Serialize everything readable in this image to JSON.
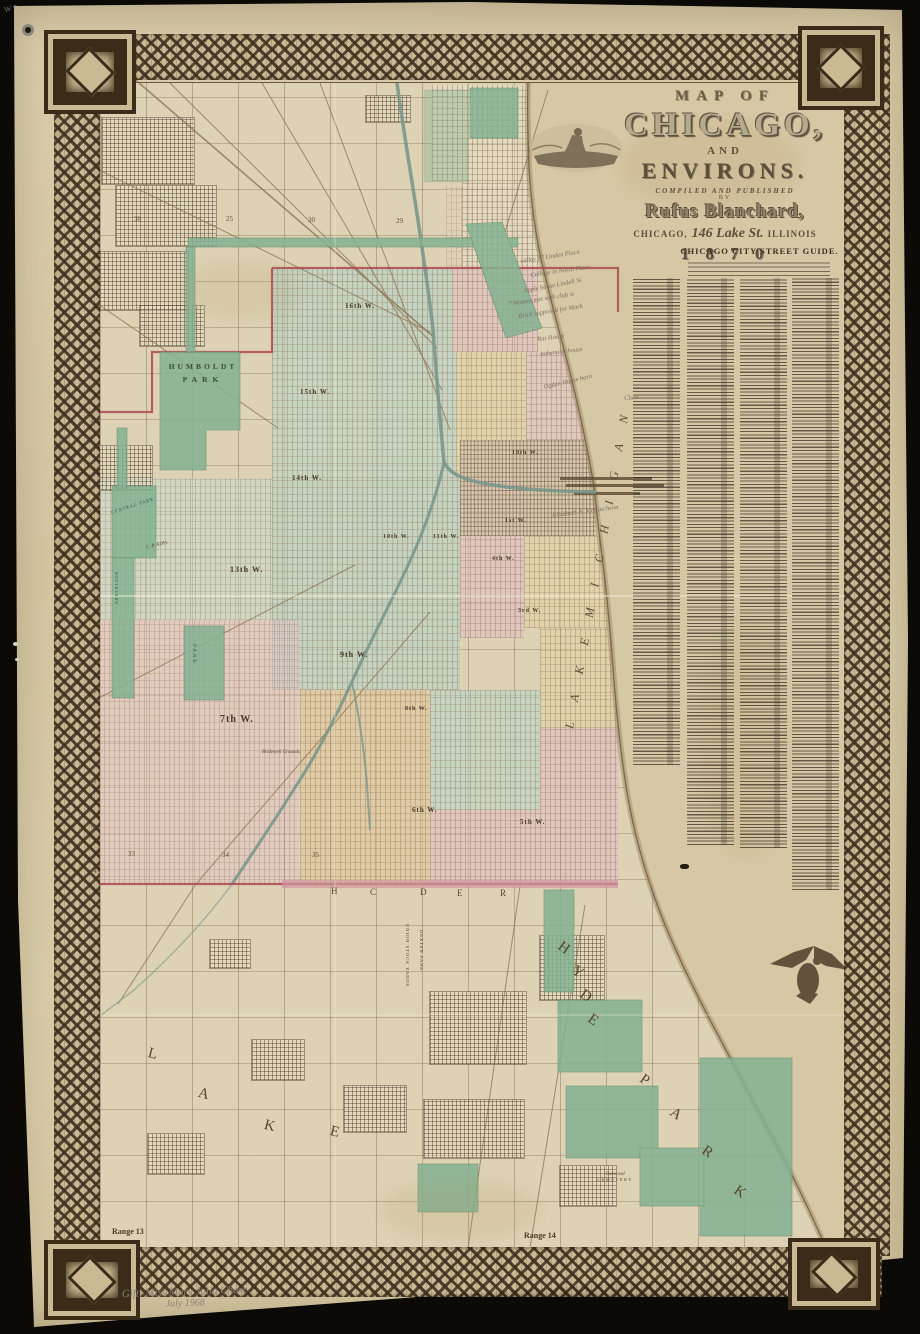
{
  "title_block": {
    "map_of": "MAP OF",
    "chicago": "CHICAGO,",
    "and": "AND",
    "environs": "ENVIRONS.",
    "compiled": "COMPILED AND PUBLISHED",
    "by": "BY",
    "publisher": "Rufus Blanchard,",
    "address_city": "CHICAGO,",
    "address_street": "146 Lake St.",
    "address_state": "ILLINOIS",
    "year": "1 8 7 0"
  },
  "street_guide": {
    "header": "CHICAGO CITY STREET GUIDE.",
    "columns": [
      {
        "x": 633,
        "top": 278,
        "h": 487
      },
      {
        "x": 687,
        "top": 278,
        "h": 567
      },
      {
        "x": 740,
        "top": 278,
        "h": 570
      },
      {
        "x": 792,
        "top": 278,
        "h": 612
      }
    ],
    "col_w": 47
  },
  "map_labels": {
    "humboldt_line1": "HUMBOLDT",
    "humboldt_line2": "PARK",
    "central_park": "CENTRAL PARK",
    "cp_add": "C. P. ADD.",
    "douglas_park": "PARK",
    "boulevard": "BOULEVARD",
    "bridewell": "Bridewell Grounds",
    "union_stock_yards": "UNION STOCK YARDS",
    "dexter_park": "DEXTER PARK",
    "oakwood_line1": "Oakwood",
    "oakwood_line2": "CEMETERY",
    "lake_michigan": "L A K E   M I C H I G A N"
  },
  "ward_labels": [
    {
      "t": "16th W.",
      "x": 345,
      "y": 302,
      "s": 7
    },
    {
      "t": "15th W.",
      "x": 300,
      "y": 388,
      "s": 7
    },
    {
      "t": "14th W.",
      "x": 292,
      "y": 474,
      "s": 7
    },
    {
      "t": "13th W.",
      "x": 230,
      "y": 565,
      "s": 8
    },
    {
      "t": "18th W.",
      "x": 512,
      "y": 450,
      "s": 6
    },
    {
      "t": "10th W.",
      "x": 383,
      "y": 534,
      "s": 6
    },
    {
      "t": "11th W.",
      "x": 433,
      "y": 534,
      "s": 6
    },
    {
      "t": "1st W.",
      "x": 505,
      "y": 518,
      "s": 6
    },
    {
      "t": "4th W.",
      "x": 492,
      "y": 556,
      "s": 6
    },
    {
      "t": "3rd W.",
      "x": 518,
      "y": 608,
      "s": 6
    },
    {
      "t": "9th W.",
      "x": 340,
      "y": 650,
      "s": 8
    },
    {
      "t": "8th W.",
      "x": 405,
      "y": 706,
      "s": 6
    },
    {
      "t": "7th W.",
      "x": 220,
      "y": 714,
      "s": 10
    },
    {
      "t": "6th W.",
      "x": 412,
      "y": 806,
      "s": 7
    },
    {
      "t": "5th W.",
      "x": 520,
      "y": 818,
      "s": 7
    }
  ],
  "margin_numbers": [
    {
      "t": "1",
      "y": 283
    },
    {
      "t": "2",
      "y": 328
    },
    {
      "t": "3",
      "y": 373
    },
    {
      "t": "4",
      "y": 418
    },
    {
      "t": "5",
      "y": 463
    },
    {
      "t": "6",
      "y": 508
    },
    {
      "t": "7",
      "y": 553
    },
    {
      "t": "8",
      "y": 598
    },
    {
      "t": "9",
      "y": 643
    },
    {
      "t": "10",
      "y": 688
    },
    {
      "t": "11",
      "y": 733
    },
    {
      "t": "12",
      "y": 778
    },
    {
      "t": "13",
      "y": 823
    },
    {
      "t": "14",
      "y": 868
    }
  ],
  "section_numbers": [
    {
      "t": "36",
      "x": 134,
      "y": 215
    },
    {
      "t": "25",
      "x": 226,
      "y": 215
    },
    {
      "t": "30",
      "x": 308,
      "y": 216
    },
    {
      "t": "29",
      "x": 396,
      "y": 217
    },
    {
      "t": "33",
      "x": 128,
      "y": 850
    },
    {
      "t": "34",
      "x": 222,
      "y": 851
    },
    {
      "t": "35",
      "x": 312,
      "y": 851
    }
  ],
  "big_letters": {
    "lake_township": [
      {
        "ch": "L",
        "x": 148,
        "y": 1046,
        "r": 14
      },
      {
        "ch": "A",
        "x": 198,
        "y": 1086,
        "r": 14
      },
      {
        "ch": "K",
        "x": 264,
        "y": 1118,
        "r": 14
      },
      {
        "ch": "E",
        "x": 330,
        "y": 1124,
        "r": 14
      }
    ],
    "hyde_park_diagonal": [
      {
        "ch": "H",
        "x": 558,
        "y": 940,
        "r": 35
      },
      {
        "ch": "Y",
        "x": 572,
        "y": 964,
        "r": 35
      },
      {
        "ch": "D",
        "x": 580,
        "y": 988,
        "r": 35
      },
      {
        "ch": "E",
        "x": 588,
        "y": 1012,
        "r": 35
      },
      {
        "ch": "P",
        "x": 640,
        "y": 1072,
        "r": 35
      },
      {
        "ch": "A",
        "x": 670,
        "y": 1106,
        "r": 35
      },
      {
        "ch": "R",
        "x": 702,
        "y": 1144,
        "r": 35
      },
      {
        "ch": "K",
        "x": 734,
        "y": 1184,
        "r": 35
      }
    ],
    "township_line": [
      {
        "ch": "H",
        "x": 331,
        "y": 886,
        "r": 0
      },
      {
        "ch": "C",
        "x": 370,
        "y": 887,
        "r": 0
      },
      {
        "ch": "D",
        "x": 420,
        "y": 887,
        "r": 0
      },
      {
        "ch": "E",
        "x": 457,
        "y": 888,
        "r": 0
      },
      {
        "ch": "R",
        "x": 500,
        "y": 888,
        "r": 0
      }
    ]
  },
  "range_labels": {
    "left": "Range 13",
    "right": "Range 14"
  },
  "annotations": {
    "pencil_notes": [
      {
        "t": "valley 17 Linden Place",
        "x": 520,
        "y": 258,
        "r": -9
      },
      {
        "t": "College in North Place",
        "x": 530,
        "y": 272,
        "r": -8
      },
      {
        "t": "Apple house Lindell St",
        "x": 523,
        "y": 288,
        "r": -11
      },
      {
        "t": "7 Women met with club st",
        "x": 508,
        "y": 301,
        "r": -9
      },
      {
        "t": "Brick supposed for Mark",
        "x": 518,
        "y": 313,
        "r": -9
      },
      {
        "t": "Rat House",
        "x": 537,
        "y": 336,
        "r": -7
      },
      {
        "t": "bohemian house",
        "x": 540,
        "y": 351,
        "r": -7
      },
      {
        "t": "Ogden House barn",
        "x": 543,
        "y": 384,
        "r": -13
      },
      {
        "t": "Clark",
        "x": 624,
        "y": 395,
        "r": -5
      },
      {
        "t": "Elizabeth A. McCutcheon",
        "x": 552,
        "y": 512,
        "r": -7
      }
    ],
    "gift_line1": "Gift: Miss Mary Julia Chase",
    "gift_line2": "July 1968",
    "corner_mark": "W 9"
  },
  "colors": {
    "paper": "#d8cba9",
    "border_ink": "#382a18",
    "crimson_boundary": "#ad4a52",
    "park_green": "#83b293",
    "ward_teal": "#b7d3c8",
    "ward_pink": "#e3bfc2",
    "ward_peach": "#e6d2a6",
    "river": "#7a978c",
    "lake": "#d6c8a5"
  }
}
